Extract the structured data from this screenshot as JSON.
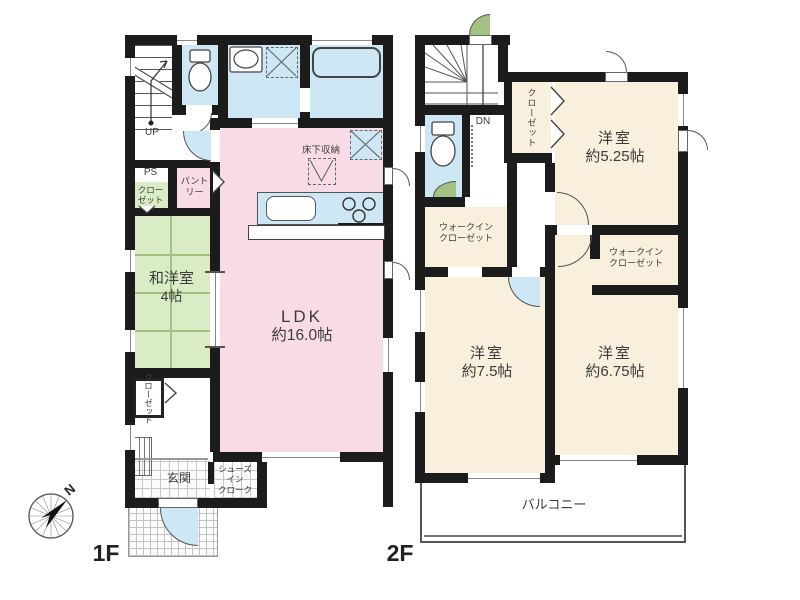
{
  "f1": {
    "floor_label": "1F",
    "stair_label": "UP",
    "ps_label": "PS",
    "ps_closet_line1": "クロー",
    "ps_closet_line2": "ゼット",
    "pantry_line1": "パント",
    "pantry_line2": "リー",
    "washitsu_line1": "和洋室",
    "washitsu_line2": "4帖",
    "ldk_line1": "LDK",
    "ldk_line2": "約16.0帖",
    "underfloor_label": "床下収納",
    "closet_label": "クローゼット",
    "genkan_label": "玄関",
    "sic_line1": "シューズ",
    "sic_line2": "イン",
    "sic_line3": "クローク"
  },
  "f2": {
    "floor_label": "2F",
    "stair_label": "DN",
    "closet_label": "クローゼット",
    "room525_line1": "洋室",
    "room525_line2": "約5.25帖",
    "wic_left_line1": "ウォークイン",
    "wic_left_line2": "クローゼット",
    "wic_right_line1": "ウォークイン",
    "wic_right_line2": "クローゼット",
    "room75_line1": "洋室",
    "room75_line2": "約7.5帖",
    "room675_line1": "洋室",
    "room675_line2": "約6.75帖",
    "balcony_label": "バルコニー"
  },
  "compass": {
    "north_label": "N"
  },
  "colors": {
    "wall": "#1c1c1c",
    "pink": "#f8dbe7",
    "blue": "#cde7f5",
    "green": "#daecc6",
    "cream": "#f8efdc"
  }
}
